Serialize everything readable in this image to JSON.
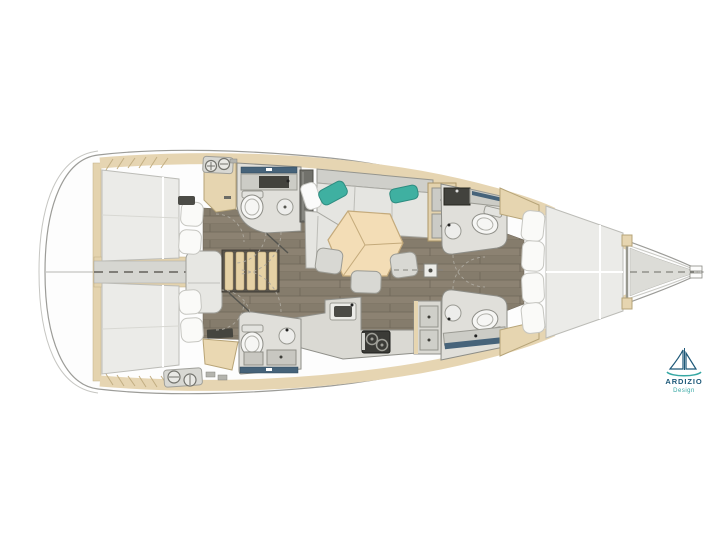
{
  "page": {
    "background_color": "#ffffff"
  },
  "plan": {
    "type": "sailing-yacht-interior-floor-plan",
    "orientation": "bow-right",
    "hull_color": "#fdfdfd",
    "floor_wood_color": "#8c8272",
    "trim_beige_color": "#e6d5b2",
    "furniture_gray_color": "#dad9d3",
    "mattress_color": "#ebebe8",
    "accent_pillow_color": "#3fb0a1",
    "shower_glass_color": "#46637a",
    "regions": [
      "swim-platform-stern",
      "aft-cabin-port",
      "aft-cabin-starboard",
      "engine-compartment",
      "companionway-stairs",
      "aft-head-port",
      "aft-head-starboard",
      "salon-sofa",
      "salon-table",
      "galley",
      "nav-station",
      "fwd-head-port",
      "fwd-head-starboard",
      "owner-cabin-vberth",
      "anchor-locker-bow"
    ]
  },
  "logo": {
    "brand": "ARDIZIO",
    "subtitle": "Design",
    "brand_color": "#1d5878",
    "subtitle_color": "#35a7a3",
    "icon": "sailboat-icon"
  }
}
